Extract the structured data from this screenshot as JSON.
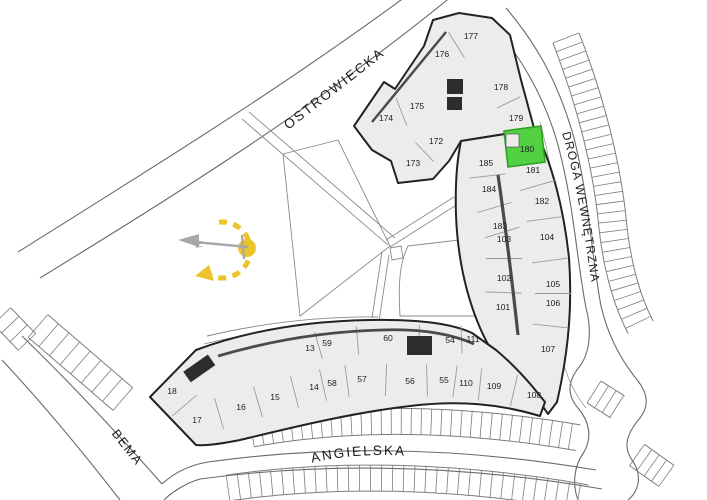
{
  "map": {
    "type": "residential-site-plan",
    "highlighted_unit": "180"
  },
  "colors": {
    "highlight_green": "#52d143",
    "green_border": "#2f9e23",
    "building_fill": "#ecedeb",
    "wall": "#222222",
    "road_line": "#6a6a6a",
    "light_line": "#8a8a8a",
    "label": "#1c1c1c",
    "compass_yellow": "#ecc32a",
    "compass_gray": "#a8a8a8"
  },
  "streets": {
    "ostrowiecka": {
      "label": "OSTROWIECKA",
      "x": 337,
      "y": 92,
      "rotate": -38
    },
    "bema": {
      "label": "BEMA",
      "x": 124,
      "y": 450,
      "rotate": 52
    },
    "angielska": {
      "label": "ANGIELSKA"
    },
    "droga": {
      "label": "DROGA WEWNĘTRZNA"
    }
  },
  "compass": {
    "north_label": "N"
  },
  "units": [
    {
      "n": "174",
      "x": 386,
      "y": 118
    },
    {
      "n": "175",
      "x": 417,
      "y": 106
    },
    {
      "n": "176",
      "x": 442,
      "y": 54
    },
    {
      "n": "177",
      "x": 471,
      "y": 36
    },
    {
      "n": "178",
      "x": 501,
      "y": 87
    },
    {
      "n": "179",
      "x": 516,
      "y": 118
    },
    {
      "n": "172",
      "x": 436,
      "y": 141
    },
    {
      "n": "173",
      "x": 413,
      "y": 163
    },
    {
      "n": "180",
      "x": 527,
      "y": 149,
      "highlight": true
    },
    {
      "n": "185",
      "x": 486,
      "y": 163
    },
    {
      "n": "181",
      "x": 533,
      "y": 170
    },
    {
      "n": "184",
      "x": 489,
      "y": 189
    },
    {
      "n": "182",
      "x": 542,
      "y": 201
    },
    {
      "n": "183",
      "x": 500,
      "y": 226
    },
    {
      "n": "103",
      "x": 504,
      "y": 239
    },
    {
      "n": "104",
      "x": 547,
      "y": 237
    },
    {
      "n": "102",
      "x": 504,
      "y": 278
    },
    {
      "n": "105",
      "x": 553,
      "y": 284
    },
    {
      "n": "101",
      "x": 503,
      "y": 307
    },
    {
      "n": "106",
      "x": 553,
      "y": 303
    },
    {
      "n": "107",
      "x": 548,
      "y": 349
    },
    {
      "n": "111",
      "x": 473,
      "y": 339
    },
    {
      "n": "54",
      "x": 450,
      "y": 340
    },
    {
      "n": "60",
      "x": 388,
      "y": 338
    },
    {
      "n": "59",
      "x": 327,
      "y": 343
    },
    {
      "n": "13",
      "x": 310,
      "y": 348
    },
    {
      "n": "14",
      "x": 314,
      "y": 387
    },
    {
      "n": "15",
      "x": 275,
      "y": 397
    },
    {
      "n": "16",
      "x": 241,
      "y": 407
    },
    {
      "n": "17",
      "x": 197,
      "y": 420
    },
    {
      "n": "18",
      "x": 172,
      "y": 391
    },
    {
      "n": "58",
      "x": 332,
      "y": 383
    },
    {
      "n": "57",
      "x": 362,
      "y": 379
    },
    {
      "n": "56",
      "x": 410,
      "y": 381
    },
    {
      "n": "55",
      "x": 444,
      "y": 380
    },
    {
      "n": "110",
      "x": 466,
      "y": 383
    },
    {
      "n": "109",
      "x": 494,
      "y": 386
    },
    {
      "n": "108",
      "x": 534,
      "y": 395
    }
  ]
}
